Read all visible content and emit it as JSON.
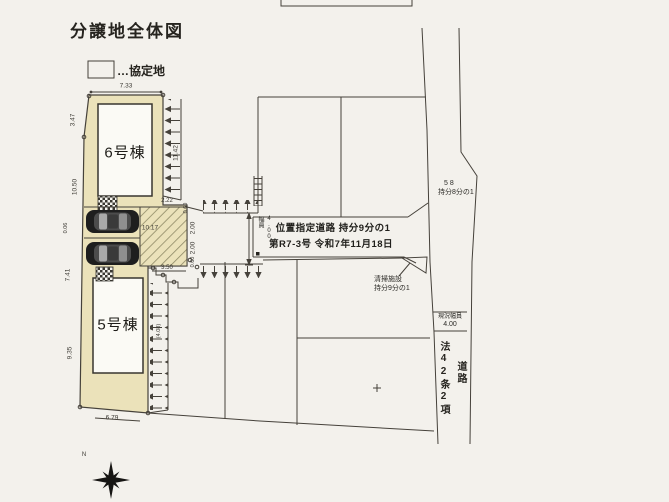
{
  "title": "分譲地全体図",
  "legend": {
    "label": "…協定地"
  },
  "buildings": {
    "b6": "6号棟",
    "b5": "5号棟"
  },
  "road_box": {
    "line1": "位置指定道路 持分9分の1",
    "line2": "第R7-3号 令和7年11月18日",
    "width_label": "幅員",
    "width_value": "4.00"
  },
  "notes": {
    "cleaning_l1": "清掃施設",
    "cleaning_l2": "持分9分の1",
    "share_l1": "5 8",
    "share_l2": "持分8分の1",
    "genkyo_l1": "現況幅員",
    "genkyo_l2": "4.00",
    "law_road_col1": "法42条2項",
    "law_road_col2": "道路",
    "north": "N"
  },
  "dims": {
    "top733": "7.33",
    "l347": "3.47",
    "l1050": "10.50",
    "l006": "0.06",
    "l741": "7.41",
    "l935": "9.35",
    "b679": "6.79",
    "e1142": "11.42",
    "d222": "2.22",
    "d060a": "0.60",
    "d200a": "2.00",
    "d200b": "2.00",
    "d060b": "0.60",
    "d350": "3.50",
    "d1017": "10.17",
    "d408": "(4.08)"
  },
  "colors": {
    "background": "#f3f1ec",
    "lot_fill": "#ebe2ba",
    "line": "#45413a",
    "hatch": "#8f8a66",
    "building_fill": "#fbfaf5"
  }
}
